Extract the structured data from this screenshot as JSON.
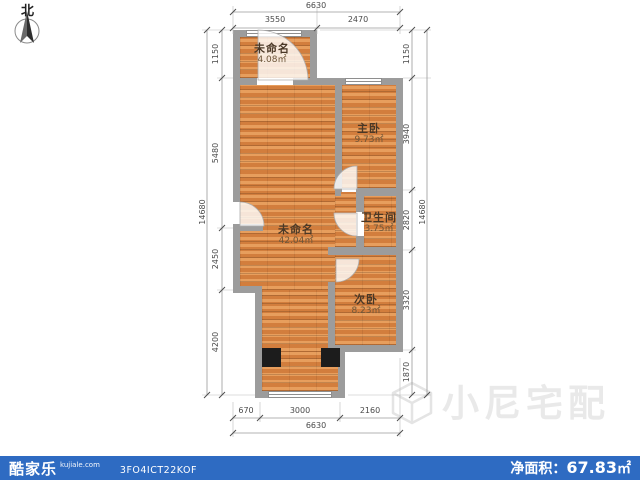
{
  "compass": {
    "label": "北"
  },
  "rooms": [
    {
      "name": "未命名",
      "area": "4.08㎡"
    },
    {
      "name": "主卧",
      "area": "9.73㎡"
    },
    {
      "name": "未命名",
      "area": "42.04㎡"
    },
    {
      "name": "卫生间",
      "area": "3.75㎡"
    },
    {
      "name": "次卧",
      "area": "8.23㎡"
    }
  ],
  "dimensions": {
    "top": {
      "total": "6630",
      "segments": [
        "3550",
        "2470"
      ]
    },
    "bottom": {
      "total": "6630",
      "segments": [
        "670",
        "3000",
        "2160"
      ]
    },
    "left": {
      "total": "14680",
      "segments": [
        "1150",
        "5480",
        "2450",
        "4200"
      ]
    },
    "right": {
      "total": "14680",
      "segments": [
        "1150",
        "3940",
        "2820",
        "3320",
        "1870"
      ]
    }
  },
  "watermark": {
    "text": "小尼宅配"
  },
  "footer": {
    "brand": "酷家乐",
    "brand_site": "kujiale.com",
    "plan_code": "3FO4ICT22KOF",
    "area_label": "净面积：",
    "area_value": "67.83",
    "area_unit": "㎡"
  },
  "colors": {
    "floor": "#dd8b49",
    "wall": "#9c9c9c",
    "footer_bar": "#2e6bc2"
  }
}
